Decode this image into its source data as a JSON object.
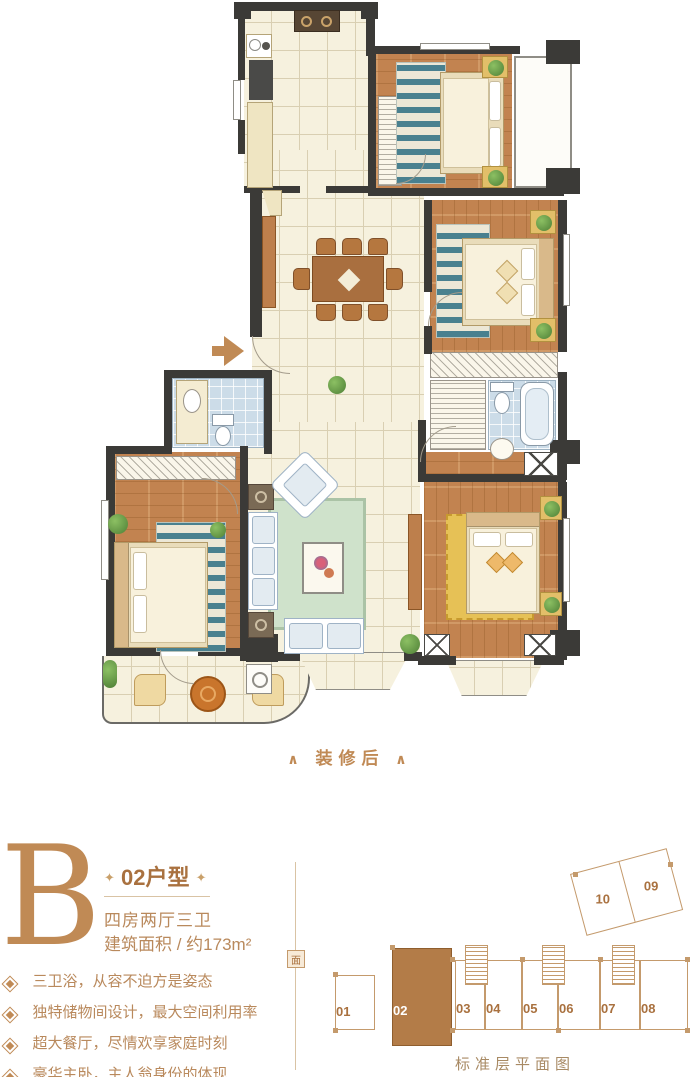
{
  "colors": {
    "accent": "#c08a55",
    "heading": "#a9713f",
    "body_text": "#b9895c",
    "divider": "#d9c3a4",
    "wall": "#3b3a37",
    "wood": "#c28350",
    "wood_line": "#a66a33",
    "tile": "#f6f1de",
    "tile_line": "#d9cfb2",
    "bath": "#ccdce8",
    "rug_green": "#cfe2cb",
    "rug_stripe": "#49808f",
    "rug_yellow": "#e6c156",
    "keyplan_line": "#c49a6c",
    "unit_fill": "#b37c48"
  },
  "floorplan": {
    "after_label": "装修后",
    "chevron": "∧"
  },
  "unit_info": {
    "letter": "B",
    "ornament": "✦",
    "title": "02户型",
    "layout": "四房两厅三卫",
    "area": "建筑面积 / 约173m²",
    "features": [
      "三卫浴，从容不迫方是姿态",
      "独特储物间设计，最大空间利用率",
      "超大餐厅，尽情欢享家庭时刻",
      "豪华主卧，主人翁身份的体现"
    ]
  },
  "keyplan": {
    "units": [
      "01",
      "02",
      "03",
      "04",
      "05",
      "06",
      "07",
      "08"
    ],
    "angled_units": [
      "10",
      "09"
    ],
    "highlighted": "02",
    "caption": "标准层平面图",
    "seal": "面"
  }
}
